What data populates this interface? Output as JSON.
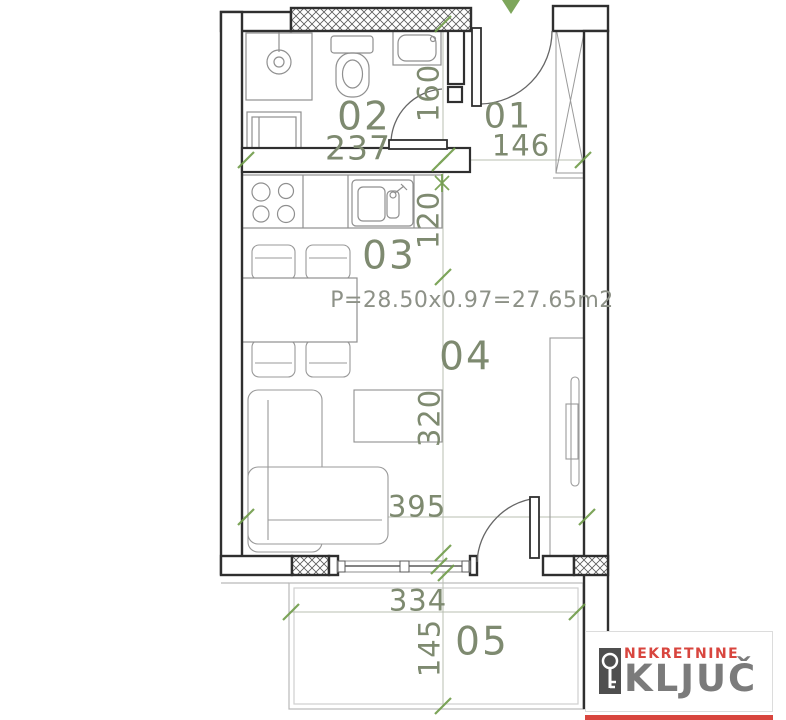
{
  "floor_plan": {
    "room_labels": {
      "entry": "01",
      "bathroom": "02",
      "kitchen": "03",
      "living": "04",
      "terrace": "05"
    },
    "dimensions": {
      "bathroom_width": "237",
      "entry_width": "146",
      "entry_depth": "160",
      "kitchen_depth": "120",
      "living_depth": "320",
      "living_width": "395",
      "terrace_width": "334",
      "terrace_depth": "145"
    },
    "area_formula": "P=28.50x0.97=27.65m2",
    "colors": {
      "wall_line": "#2f2f2f",
      "furniture_line": "#8f8f8f",
      "annotation_green": "#7e8a70",
      "tick_green": "#6f9c49",
      "formula_gray": "#8d9187"
    }
  },
  "logo": {
    "tagline": "NEKRETNINE",
    "brand": "KLJUČ",
    "tagline_color": "#d8453e",
    "brand_color": "#7b7b7b",
    "accent_bar_color": "#d8453e"
  }
}
